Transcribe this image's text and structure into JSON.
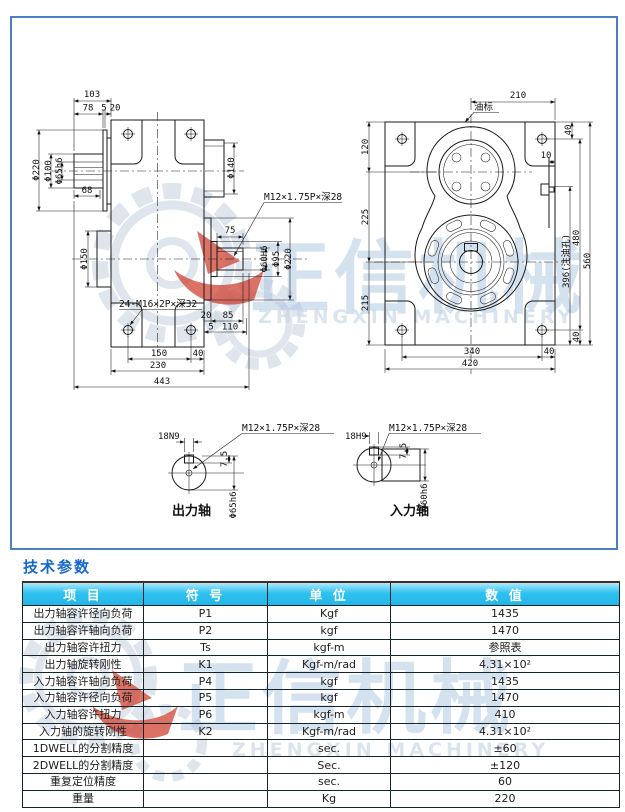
{
  "colors": {
    "frame_border": "#4a7ec7",
    "title_blue": "#1668cc",
    "table_header_cyan": "#2fc2f0",
    "watermark_blue": "#aac4e0",
    "watermark_red": "#cf3b2b",
    "line_ink": "#1a1a1a"
  },
  "watermark": {
    "cn": "正信机械",
    "en": "ZHENGXIN MACHINERY"
  },
  "drawing": {
    "labels": {
      "l103": "103",
      "l78": "78",
      "l5a": "5",
      "l20a": "20",
      "d220L": "Φ220",
      "d100": "Φ100",
      "d65h6": "Φ65h6",
      "l68": "68",
      "d150": "Φ150",
      "d140": "Φ140",
      "m12side": "M12×1.75P×深28",
      "l75": "75",
      "d60H6": "Φ60H6",
      "d95": "Φ95",
      "d220R": "Φ220",
      "l20b": "20",
      "l85": "85",
      "l5b": "5",
      "l110": "110",
      "m24": "24-M16×2P×深32",
      "l150": "150",
      "l40a": "40",
      "l230": "230",
      "l443": "443",
      "l210": "210",
      "oil": "油标",
      "l120": "120",
      "l225": "225",
      "l215": "215",
      "l40t": "40",
      "l10": "10",
      "l396": "396(注油孔)",
      "l480": "480",
      "l560": "560",
      "l40r": "40",
      "l340": "340",
      "l40b": "40",
      "l420": "420",
      "ok18": "18N9",
      "okM12": "M12×1.75P×深28",
      "ok75": "7.5",
      "okDia": "Φ65h6",
      "okLabel": "出力轴",
      "ik18": "18H9",
      "ikM12": "M12×1.75P×深28",
      "ik75": "7.5",
      "ikDia": "Φ60h6",
      "ikLabel": "入力轴"
    }
  },
  "table": {
    "title": "技术参数",
    "headers": [
      "项  目",
      "符  号",
      "单  位",
      "数  值"
    ],
    "rows": [
      {
        "item": "出力轴容许径向负荷",
        "symbol": "P1",
        "unit": "Kgf",
        "value": "1435"
      },
      {
        "item": "出力轴容许轴向负荷",
        "symbol": "P2",
        "unit": "kgf",
        "value": "1470"
      },
      {
        "item": "出力轴容许扭力",
        "symbol": "Ts",
        "unit": "kgf-m",
        "value": "参照表"
      },
      {
        "item": "出力轴旋转刚性",
        "symbol": "K1",
        "unit": "Kgf-m/rad",
        "value": "4.31×10²"
      },
      {
        "item": "入力轴容许轴向负荷",
        "symbol": "P4",
        "unit": "kgf",
        "value": "1435"
      },
      {
        "item": "入力轴容许径向负荷",
        "symbol": "P5",
        "unit": "kgf",
        "value": "1470"
      },
      {
        "item": "入力轴容许扭力",
        "symbol": "P6",
        "unit": "kgf-m",
        "value": "410"
      },
      {
        "item": "入力轴的旋转刚性",
        "symbol": "K2",
        "unit": "Kgf-m/rad",
        "value": "4.31×10²"
      },
      {
        "item": "1DWELL的分割精度",
        "symbol": "",
        "unit": "sec.",
        "value": "±60"
      },
      {
        "item": "2DWELL的分割精度",
        "symbol": "",
        "unit": "Sec.",
        "value": "±120"
      },
      {
        "item": "重复定位精度",
        "symbol": "",
        "unit": "sec.",
        "value": "60"
      },
      {
        "item": "重量",
        "symbol": "",
        "unit": "Kg",
        "value": "220"
      }
    ]
  }
}
